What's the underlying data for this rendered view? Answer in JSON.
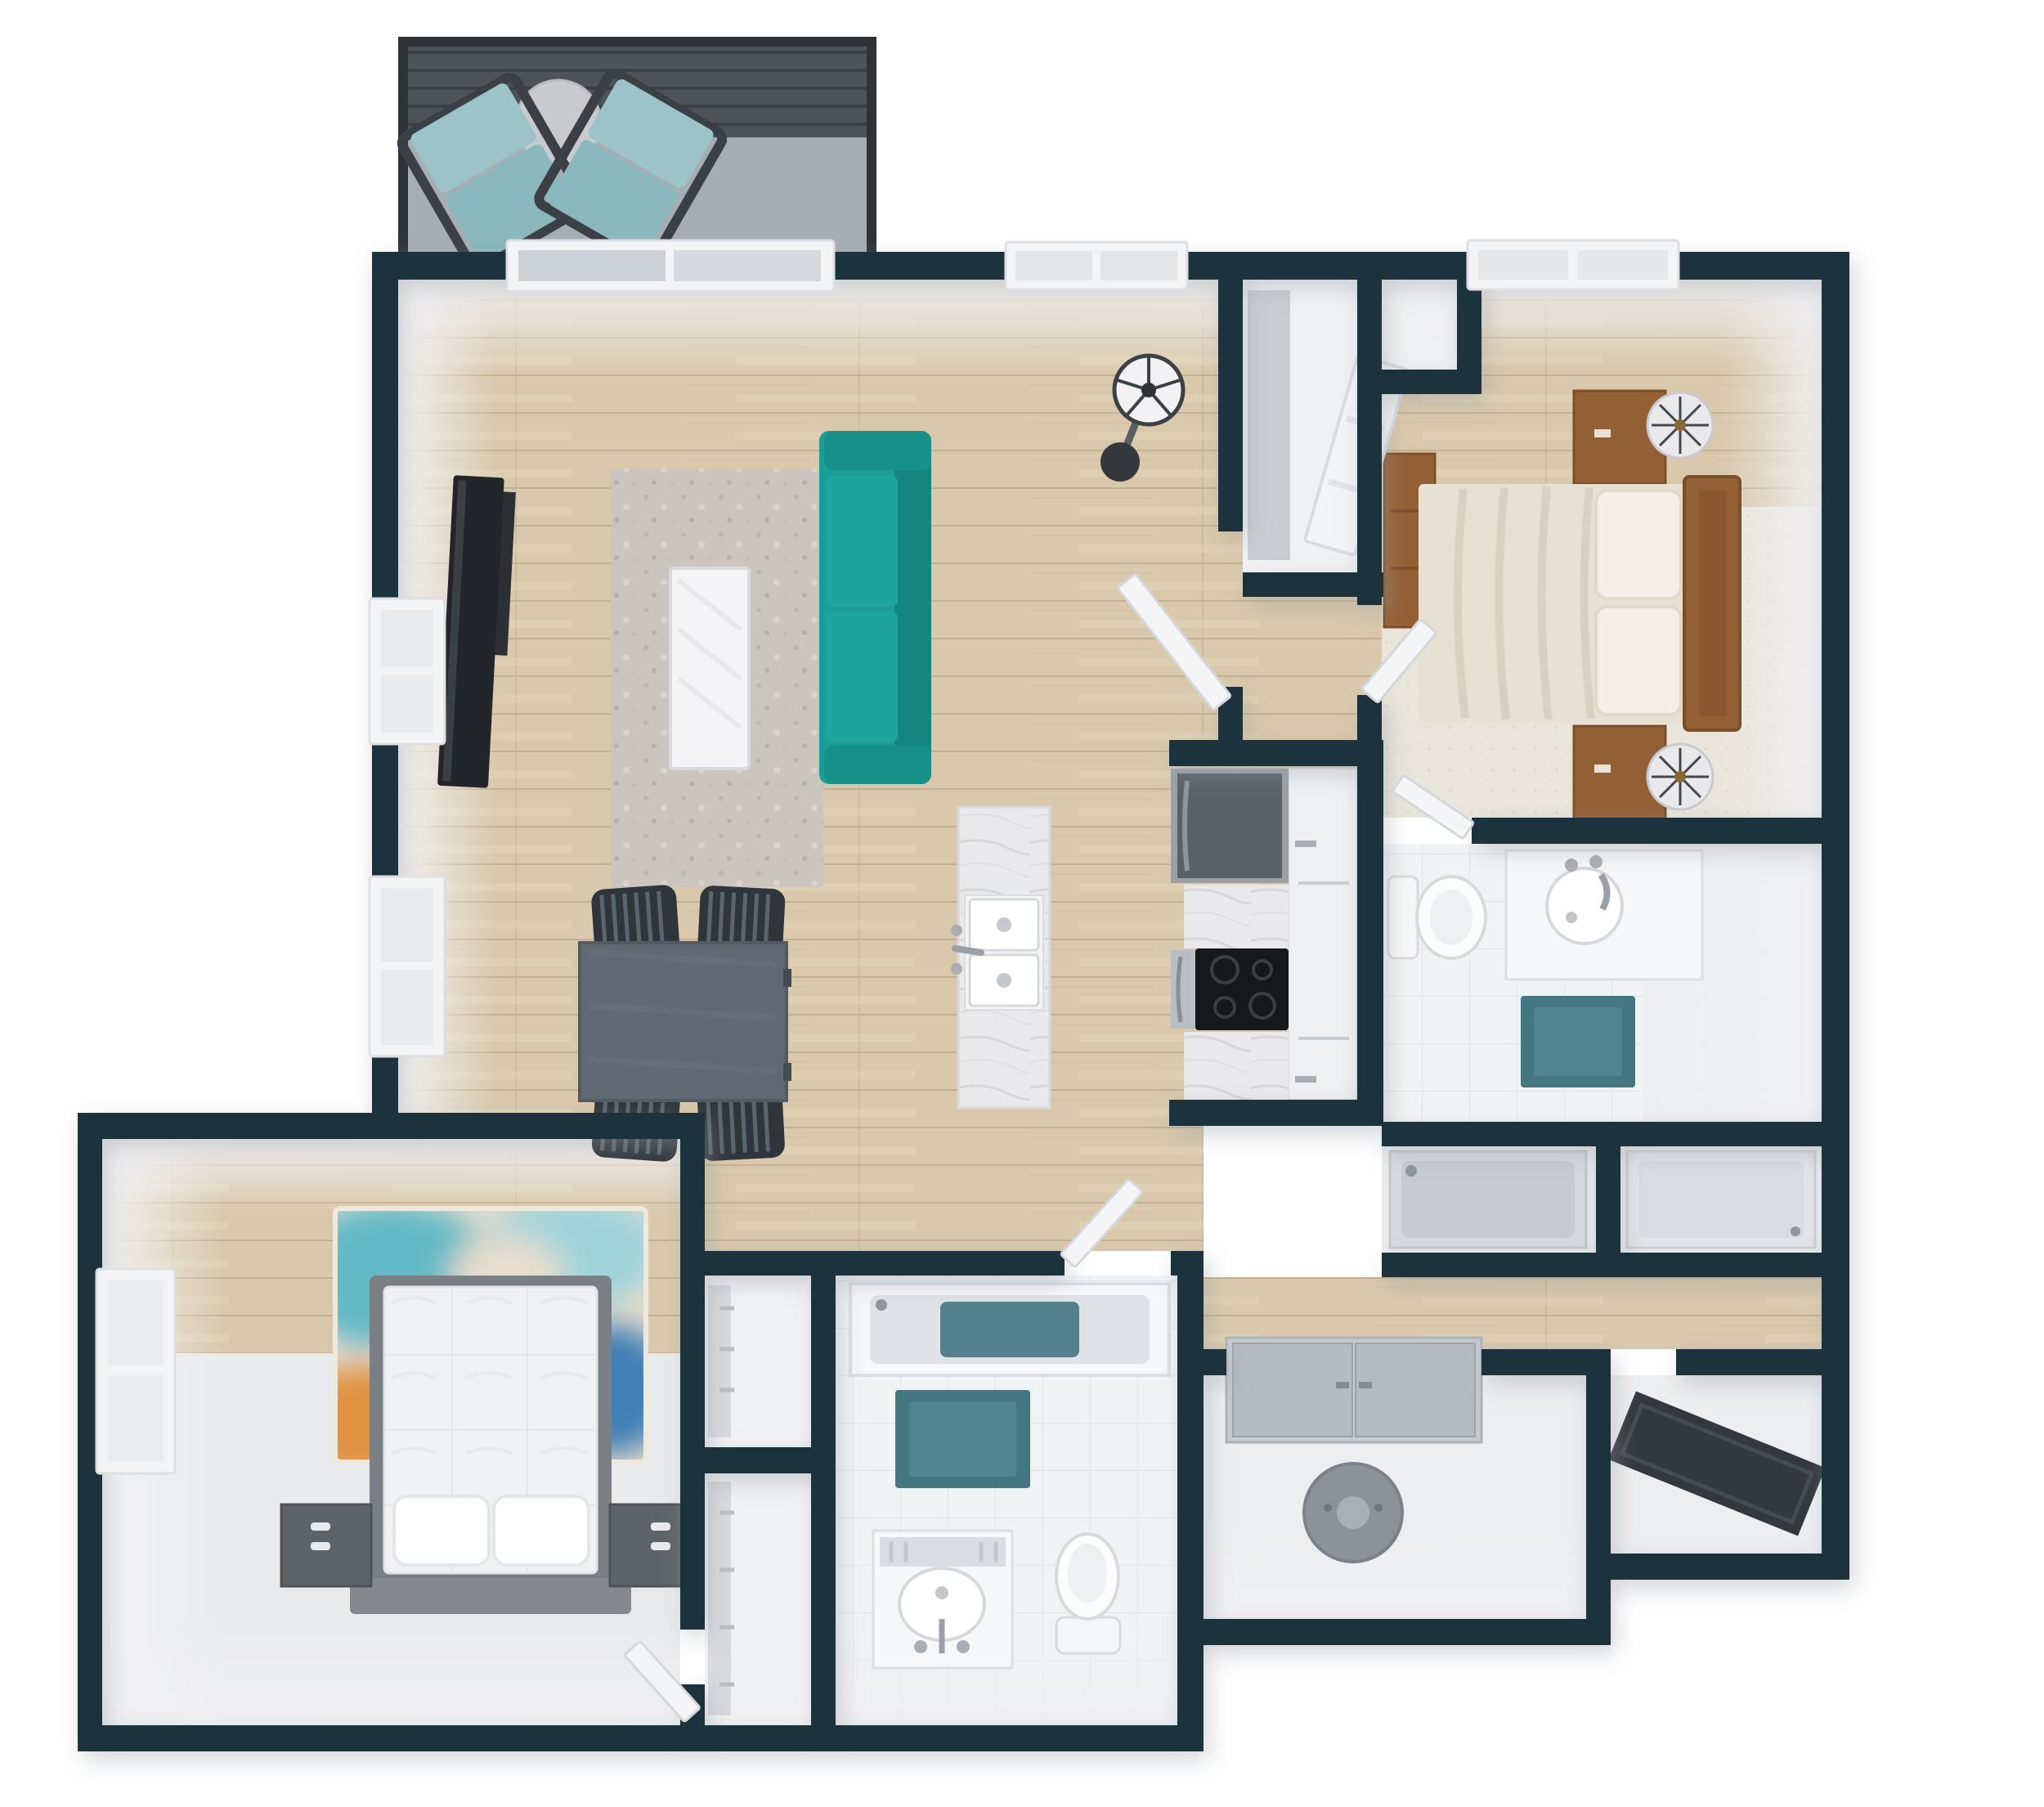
{
  "scene": {
    "type": "3d-floor-plan-top-view",
    "description": "Top-down 3D rendered apartment floor plan with balcony, open living-dining-kitchen area, two bedrooms, two bathrooms, closets, laundry and walk-in closet"
  },
  "palette": {
    "wall": "#1a333d",
    "wall_face": "#eeeef1",
    "outside": "#ffffff",
    "wood": "#d9c8ab",
    "wood_line": "#c2b091",
    "tile": "#f1f4f5",
    "plain_floor": "#ebedef",
    "deck": "#4e5358",
    "deck_line": "#3b4045",
    "concrete": "#a7adb4",
    "patio_cushion": "#8ab8bd",
    "patio_frame": "#3b4046",
    "patio_table": "#c9cacd",
    "sofa": "#1b9e97",
    "sofa_dark": "#15867f",
    "rug_gray": "#cbc5bf",
    "rug_cream": "#e9e5da",
    "coffee_table": "#f4f4f6",
    "tv": "#22262a",
    "dining_table": "#5f6873",
    "dining_chair": "#2f353b",
    "marble": "#e9e9ec",
    "cabinet": "#eef0f2",
    "fridge": "#5a6067",
    "fridge_frame": "#9aa0a6",
    "cooktop": "#16191c",
    "steel": "#b9bec4",
    "wood_furniture": "#935f35",
    "bedding": "#e7e1d4",
    "pillow": "#f3efe6",
    "lamp": "#e9e9ec",
    "bed2_frame": "#7a7f85",
    "bed2_mattress": "#f0f1f3",
    "nightstand_gray": "#5e6368",
    "bath_mat": "#447680",
    "tub_pan": "#c7cbd0",
    "fixture": "#fbfcfd",
    "appliance_gray": "#8b9298",
    "door_panel": "#b5bac1",
    "closet_dark": "#32383e",
    "window_frame": "#f3f4f6",
    "window_glass": "#ccd2d6",
    "door_leaf": "#f4f5f7",
    "rug2_teal": "#62b9c6",
    "rug2_cream": "#e7ddcd",
    "rug2_orange": "#e0923f",
    "rug2_pink": "#d4547c",
    "rug2_blue": "#3f7fb5"
  },
  "rooms": [
    {
      "name": "balcony",
      "furniture": [
        "patio-chair",
        "patio-chair",
        "patio-table"
      ]
    },
    {
      "name": "living-room",
      "furniture": [
        "tv",
        "area-rug",
        "coffee-table",
        "teal-sofa",
        "pedestal-fan",
        "windows"
      ]
    },
    {
      "name": "dining-area",
      "furniture": [
        "dining-table",
        "dining-chair-x4"
      ]
    },
    {
      "name": "kitchen",
      "furniture": [
        "island-with-double-sink",
        "refrigerator",
        "cooktop-oven",
        "marble-counters",
        "cabinets"
      ]
    },
    {
      "name": "bedroom-1",
      "furniture": [
        "queen-bed",
        "wood-headboard",
        "nightstand-x2",
        "lamp-x2",
        "dresser",
        "cream-rug",
        "window"
      ]
    },
    {
      "name": "bathroom-1",
      "furniture": [
        "toilet",
        "vanity-round-sink",
        "teal-bath-mat",
        "tub",
        "shower"
      ]
    },
    {
      "name": "entry-hall",
      "furniture": [
        "pantry-closet",
        "small-closet",
        "doors"
      ]
    },
    {
      "name": "bedroom-2",
      "furniture": [
        "platform-bed",
        "pillow-x2",
        "nightstand-x2",
        "multicolor-rug",
        "window"
      ]
    },
    {
      "name": "hall-closets",
      "furniture": [
        "shelf",
        "shelf"
      ]
    },
    {
      "name": "bathroom-2",
      "furniture": [
        "tub",
        "teal-bath-mat",
        "vanity-oval-sink",
        "toilet"
      ]
    },
    {
      "name": "laundry",
      "furniture": [
        "double-doors",
        "water-heater"
      ]
    },
    {
      "name": "walk-in-closet",
      "furniture": [
        "dark-shelf-bench"
      ]
    }
  ]
}
